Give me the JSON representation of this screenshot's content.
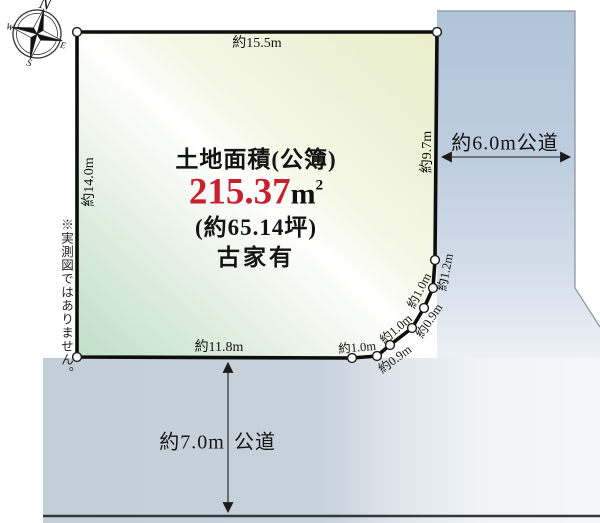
{
  "compass": {
    "n": "N",
    "e": "E",
    "s": "S",
    "w": "W"
  },
  "plot": {
    "area_title": "土地面積(公簿)",
    "area_value": "215.37",
    "area_unit": "m",
    "area_unit_sup": "2",
    "area_tsubo": "(約65.14坪)",
    "building_note": "古家有",
    "dims": {
      "top": "約15.5m",
      "left": "約14.0m",
      "right": "約9.7m",
      "bottom": "約11.8m",
      "chamfer": [
        "約1.0m",
        "約0.9m",
        "約1.0m",
        "約0.9m",
        "約1.0m",
        "約1.2m"
      ]
    }
  },
  "roads": {
    "right_label": "約6.0m公道",
    "bottom_width": "約7.0m",
    "bottom_type": "公道"
  },
  "note": "※実測図ではありません。",
  "colors": {
    "area_value_red": "#c9202e",
    "plot_green": "#c2e0cb",
    "plot_yellow": "#eaefcd",
    "road_blue": "#b2c5d8",
    "road_gray": "#c4cfd8"
  }
}
